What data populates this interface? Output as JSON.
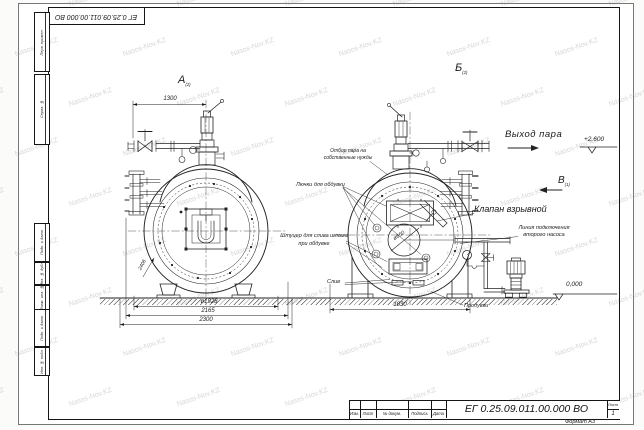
{
  "sheet": {
    "corner_stamp": "ЕГ 0.25.09.011.00.000  ВО",
    "format_note": "Формат А3",
    "margin_boxes": [
      "Перв. примен.",
      "Справ. №",
      "Подп. и дата",
      "Инв. № дубл.",
      "Взам. инв. №",
      "Подп. и дата",
      "Инв. № подл."
    ],
    "watermark_text": "Nasos-Nov.KZ"
  },
  "title_block": {
    "doc_number": "ЕГ 0.25.09.011.00.000  ВО",
    "row_labels": [
      "Изм.",
      "Лист",
      "№ докум.",
      "Подпись",
      "Дата"
    ],
    "sheet_label": "Лист",
    "sheet_number": "1"
  },
  "views": {
    "front_label": "А",
    "front_note": "(2)",
    "rear_label": "Б",
    "rear_note": "(2)",
    "direction_label": "В",
    "direction_note": "(1)"
  },
  "annotations": {
    "steam_outlet": "Выход пара",
    "steam_own_needs_1": "Отбор пара на",
    "steam_own_needs_2": "собственные нужды",
    "explosion_valve": "Клапан взрывной",
    "blow_hatches": "Лючки для обдувки",
    "sludge_nozzle_1": "Штуцер для слива шлама",
    "sludge_nozzle_2": "при обдувке",
    "drain": "Слив",
    "blowdown": "Продувки",
    "second_pump_1": "Линия подключения",
    "second_pump_2": "второго насоса"
  },
  "elevations": {
    "steam_level": "+2,600",
    "ground_level": "0,000"
  },
  "dimensions": {
    "front_top": "1300",
    "front_dia": "ø1928",
    "front_width_mid": "2165",
    "front_width_overall": "2300",
    "front_diag": "2406",
    "rear_center_dia": "ø650",
    "rear_width": "1830"
  }
}
